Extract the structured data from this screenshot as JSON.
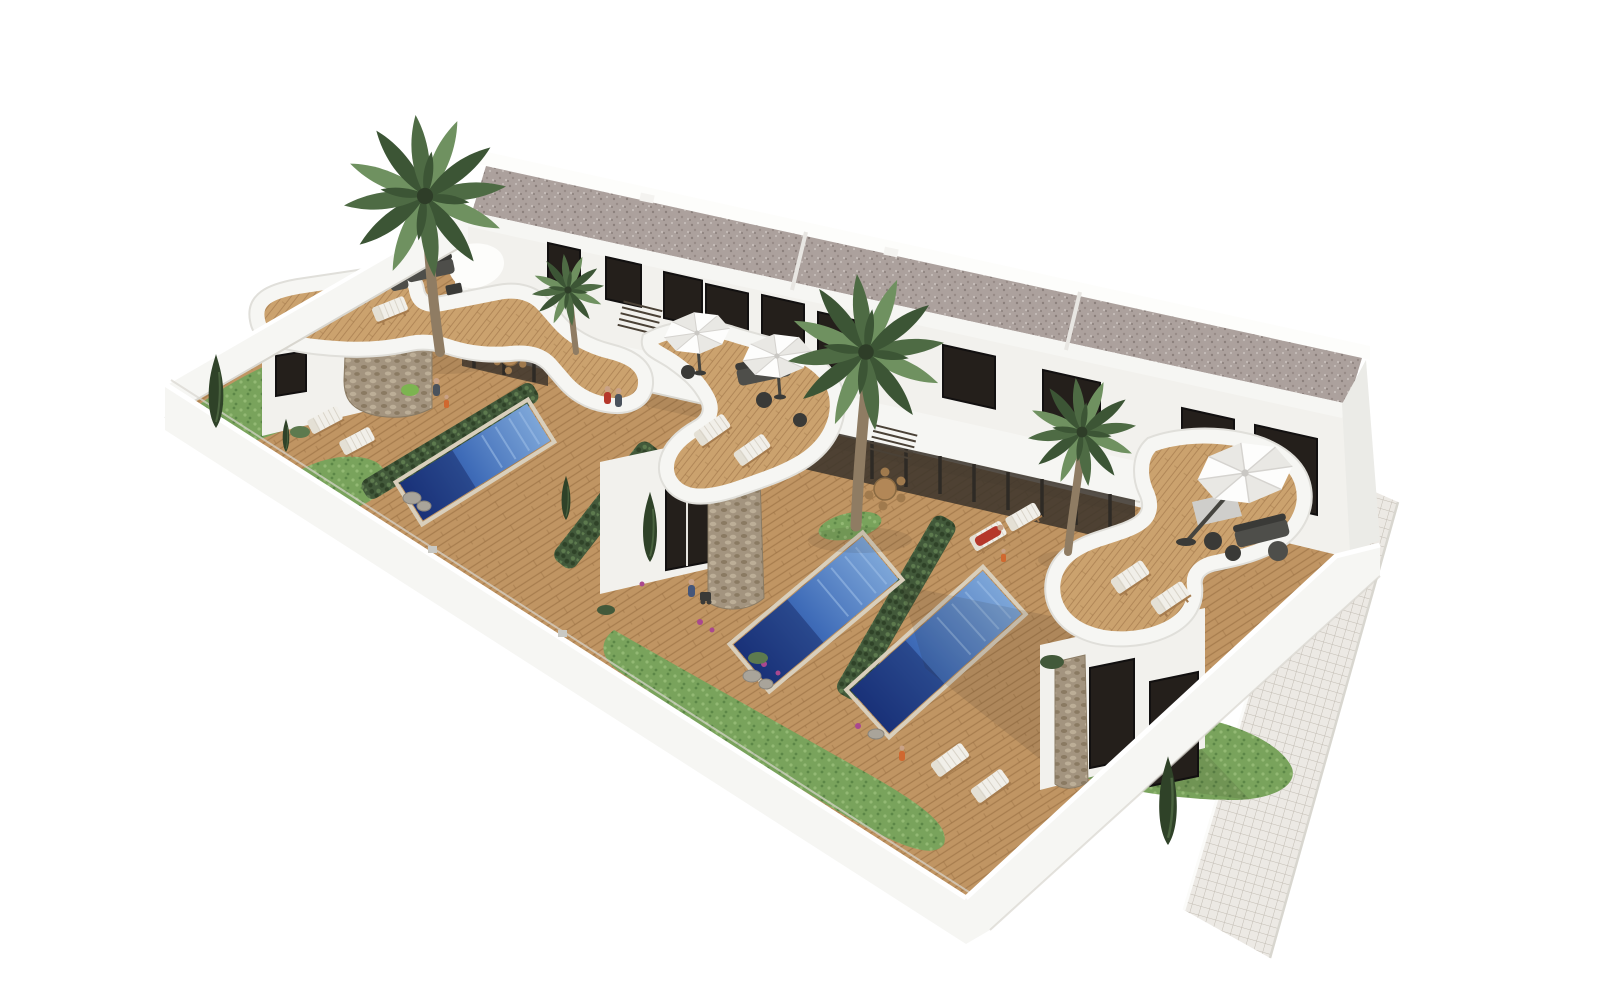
{
  "scene": {
    "type": "architectural-3d-render",
    "description": "Aerial 3D architectural rendering of a row of three modern white townhouses with curved white roof terraces, wooden decks, private blue lap pools separated by green hedges, palm trees, white parasols, sun loungers and a small-tile walkway along the right side, on a plain white background",
    "view": "high angle isometric-style birds eye",
    "background": "#ffffff"
  },
  "objects": {
    "building": {
      "stories": 2,
      "roof": "flat gray gravel with white parapet",
      "facade_windows": 10
    },
    "terraces": {
      "count": 3,
      "floor": "wood planks",
      "parapet": "curved white"
    },
    "pools": {
      "count": 3,
      "shape": "rectangular lap pool",
      "color": "blue"
    },
    "parasols": {
      "count": 3,
      "color": "white"
    },
    "palm_trees": {
      "count": 4
    },
    "cypress_trees": {
      "count": 5
    },
    "sun_loungers": {
      "count": 12
    },
    "dining_sets": {
      "count": 2
    },
    "lounge_sets": {
      "count": 3
    },
    "people": {
      "count": 9
    },
    "walkway": {
      "material": "small square tiles",
      "position": "right edge"
    },
    "perimeter_wall": {
      "color": "white"
    }
  },
  "colors": {
    "bg": "#ffffff",
    "wall": "#f6f6f3",
    "wall_bright": "#fdfdfb",
    "wall_shade": "#ebebe7",
    "wall_edge": "#d8d6cf",
    "facade": "#f2f1ed",
    "facade_shade": "#e7e5e0",
    "roof_base": "#aca19d",
    "roof_dot_dark": "#8b807c",
    "roof_dot_mid": "#978b87",
    "roof_dot_light": "#c6bdb9",
    "window": "#241f1b",
    "window_frame": "#121010",
    "wood": "#c09563",
    "wood_terrace": "#cba26e",
    "plank": "#8a6036",
    "porch_dark": "#39322a",
    "post": "#2e2a25",
    "stone": "#a3947f",
    "stone_dark": "#8a7a62",
    "stone_light": "#bcae97",
    "pool_light": "#7da6d8",
    "pool_mid": "#3f6cb8",
    "pool_deep": "#1e3d8f",
    "pool_shadow": "#14245e",
    "rim": "#d9cfbc",
    "hedge": "#42593a",
    "hedge_dark": "#2f4228",
    "hedge_light": "#5d7a4e",
    "grass": "#79a35c",
    "grass_light": "#93b974",
    "grass_dark": "#5c8747",
    "trunk": "#8f7c63",
    "palm_dark": "#3c5535",
    "palm_mid": "#4e6b44",
    "palm_light": "#6f9160",
    "umbrella": "#fdfdfc",
    "umbrella_shade": "#e9e8e4",
    "pole": "#45443f",
    "furniture": "#4e4e4a",
    "furniture_dark": "#3a3a37",
    "lounger": "#f1efe9",
    "lounger_frame": "#a67c4e",
    "tile": "#ece9e4",
    "grout": "#c2bcb3",
    "shadow": "#2f2a22",
    "skin": "#c9a286",
    "cloth_red": "#b5372b",
    "cloth_orange": "#d0682f",
    "cloth_blue": "#45567a",
    "cloth_gray": "#4a525c",
    "rug": "#cfcecb",
    "flower": "#a9488f"
  }
}
